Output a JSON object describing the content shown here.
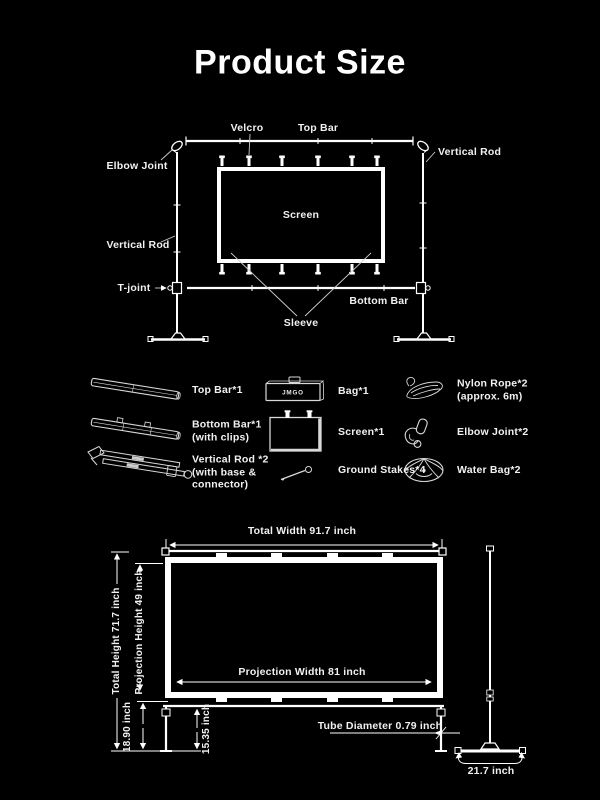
{
  "title": "Product Size",
  "colors": {
    "background": "#000000",
    "line": "#ffffff",
    "text": "#f1f1f1"
  },
  "assembly": {
    "labels": {
      "velcro": "Velcro",
      "top_bar": "Top Bar",
      "elbow_joint": "Elbow Joint",
      "vertical_rod_right": "Vertical Rod",
      "vertical_rod_left": "Vertical Rod",
      "t_joint": "T-joint",
      "bottom_bar": "Bottom Bar",
      "sleeve": "Sleeve",
      "screen": "Screen"
    }
  },
  "parts": {
    "bag_text": "JMGO",
    "items": [
      {
        "name": "top-bar",
        "label": "Top Bar*1"
      },
      {
        "name": "bag",
        "label": "Bag*1"
      },
      {
        "name": "nylon-rope",
        "label": "Nylon Rope*2\n(approx. 6m)"
      },
      {
        "name": "bottom-bar",
        "label": "Bottom Bar*1\n(with clips)"
      },
      {
        "name": "screen",
        "label": "Screen*1"
      },
      {
        "name": "elbow-joint",
        "label": "Elbow Joint*2"
      },
      {
        "name": "vertical-rod",
        "label": "Vertical Rod *2\n(with base &\nconnector)"
      },
      {
        "name": "ground-stakes",
        "label": "Ground Stakes*4"
      },
      {
        "name": "water-bag",
        "label": "Water Bag*2"
      }
    ]
  },
  "dimensions": {
    "total_width": "Total Width 91.7 inch",
    "total_height": "Total Height 71.7 inch",
    "projection_height": "Projection Height 49 inch",
    "projection_width": "Projection Width 81 inch",
    "stand_lower_height": "18.90 inch",
    "leg_height": "15.35 inch",
    "tube_diameter": "Tube Diameter 0.79 inch",
    "base_width": "21.7 inch"
  }
}
